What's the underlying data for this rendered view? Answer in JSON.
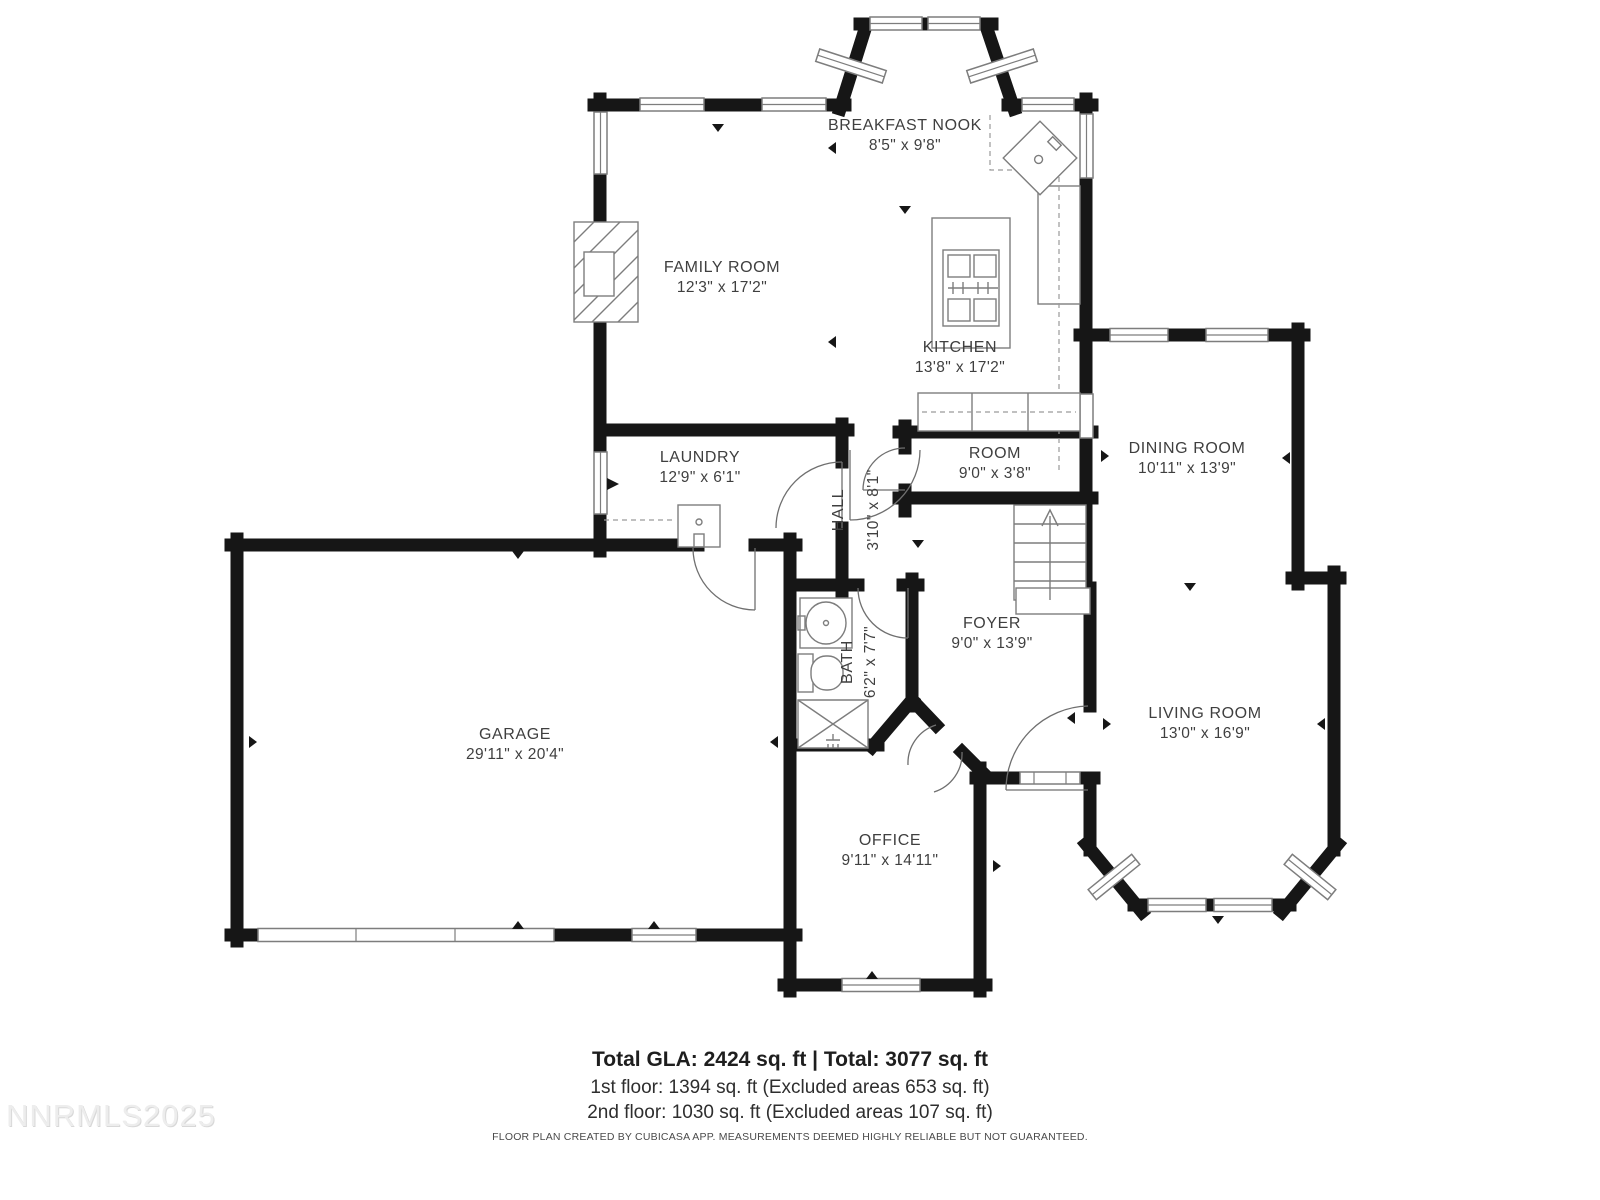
{
  "plan": {
    "rooms": [
      {
        "id": "breakfast-nook",
        "name": "BREAKFAST NOOK",
        "dims": "8'5\" x 9'8\""
      },
      {
        "id": "family-room",
        "name": "FAMILY ROOM",
        "dims": "12'3\" x 17'2\""
      },
      {
        "id": "kitchen",
        "name": "KITCHEN",
        "dims": "13'8\" x 17'2\""
      },
      {
        "id": "laundry",
        "name": "LAUNDRY",
        "dims": "12'9\" x 6'1\""
      },
      {
        "id": "hall",
        "name": "HALL",
        "dims": "3'10\" x 8'1\""
      },
      {
        "id": "room",
        "name": "ROOM",
        "dims": "9'0\" x 3'8\""
      },
      {
        "id": "dining-room",
        "name": "DINING ROOM",
        "dims": "10'11\" x 13'9\""
      },
      {
        "id": "foyer",
        "name": "FOYER",
        "dims": "9'0\" x 13'9\""
      },
      {
        "id": "bath",
        "name": "BATH",
        "dims": "6'2\" x 7'7\""
      },
      {
        "id": "living-room",
        "name": "LIVING ROOM",
        "dims": "13'0\" x 16'9\""
      },
      {
        "id": "garage",
        "name": "GARAGE",
        "dims": "29'11\" x 20'4\""
      },
      {
        "id": "office",
        "name": "OFFICE",
        "dims": "9'11\" x 14'11\""
      }
    ]
  },
  "footer": {
    "totals": "Total GLA: 2424 sq. ft | Total: 3077 sq. ft",
    "first_floor": "1st floor: 1394 sq. ft (Excluded areas 653 sq. ft)",
    "second_floor": "2nd floor: 1030 sq. ft (Excluded areas 107 sq. ft)",
    "disclaimer": "FLOOR PLAN CREATED BY CUBICASA APP. MEASUREMENTS DEEMED HIGHLY RELIABLE BUT NOT GUARANTEED."
  },
  "watermark": "NNRMLS2025",
  "colors": {
    "wall": "#161616",
    "label_text": "#3f3f3f",
    "fixture_line": "#7d7d7d",
    "watermark_gray": "#ededed",
    "background": "#ffffff"
  }
}
